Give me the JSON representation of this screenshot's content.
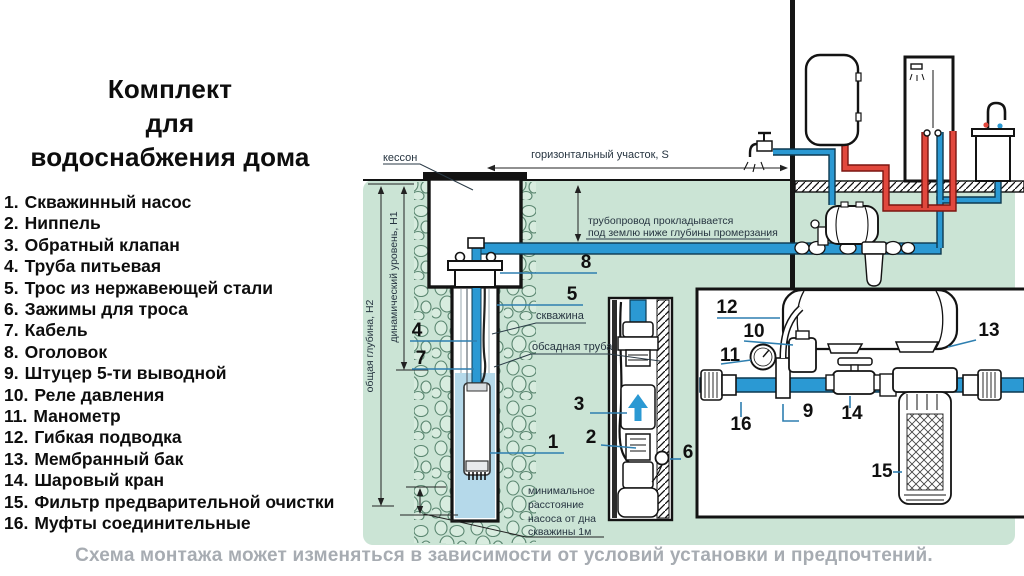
{
  "title": {
    "line1": "Комплект",
    "line2": "для",
    "line3": "водоснабжения дома"
  },
  "legend": {
    "items": [
      {
        "num": "1.",
        "label": "Скважинный насос"
      },
      {
        "num": "2.",
        "label": "Ниппель"
      },
      {
        "num": "3.",
        "label": "Обратный клапан"
      },
      {
        "num": "4.",
        "label": "Труба питьевая"
      },
      {
        "num": "5.",
        "label": "Трос из нержавеющей стали"
      },
      {
        "num": "6.",
        "label": "Зажимы для троса"
      },
      {
        "num": "7.",
        "label": "Кабель"
      },
      {
        "num": "8.",
        "label": "Оголовок"
      },
      {
        "num": "9.",
        "label": "Штуцер 5-ти выводной"
      },
      {
        "num": "10.",
        "label": "Реле давления"
      },
      {
        "num": "11.",
        "label": "Манометр"
      },
      {
        "num": "12.",
        "label": "Гибкая подводка"
      },
      {
        "num": "13.",
        "label": "Мембранный бак"
      },
      {
        "num": "14.",
        "label": "Шаровый кран"
      },
      {
        "num": "15.",
        "label": "Фильтр предварительной очистки"
      },
      {
        "num": "16.",
        "label": "Муфты соединительные"
      }
    ]
  },
  "footnote": "Схема монтажа может изменяться в зависимости от условий установки и предпочтений.",
  "diagram": {
    "labels": {
      "kesson": "кессон",
      "horizontal_section": "горизонтальный участок,  S",
      "pipeline_note_line1": "трубопровод  прокладывается",
      "pipeline_note_line2": "под  землю  ниже  глубины  промерзания",
      "total_depth": "общая  глубина,  Н2",
      "dynamic_level": "динамический  уровень,  Н1",
      "well": "скважина",
      "casing_pipe": "обсадная  труба",
      "min_distance_line1": "минимальное",
      "min_distance_line2": "расстояние",
      "min_distance_line3": "насоса  от  дна",
      "min_distance_line4": "скважины  1м"
    },
    "callouts": {
      "c1": "1",
      "c2": "2",
      "c3": "3",
      "c4": "4",
      "c5": "5",
      "c6": "6",
      "c7": "7",
      "c8": "8",
      "c9": "9",
      "c10": "10",
      "c11": "11",
      "c12": "12",
      "c13": "13",
      "c14": "14",
      "c15": "15",
      "c16": "16"
    },
    "colors": {
      "earth": "#cbe4d5",
      "stone_outline": "#5a8670",
      "water": "#b5d9ea",
      "cold_pipe": "#2b99d3",
      "hot_pipe": "#e1483d",
      "outline": "#131313",
      "callout_line": "#2e7fb0",
      "footnote_text": "#a7acb2"
    }
  }
}
